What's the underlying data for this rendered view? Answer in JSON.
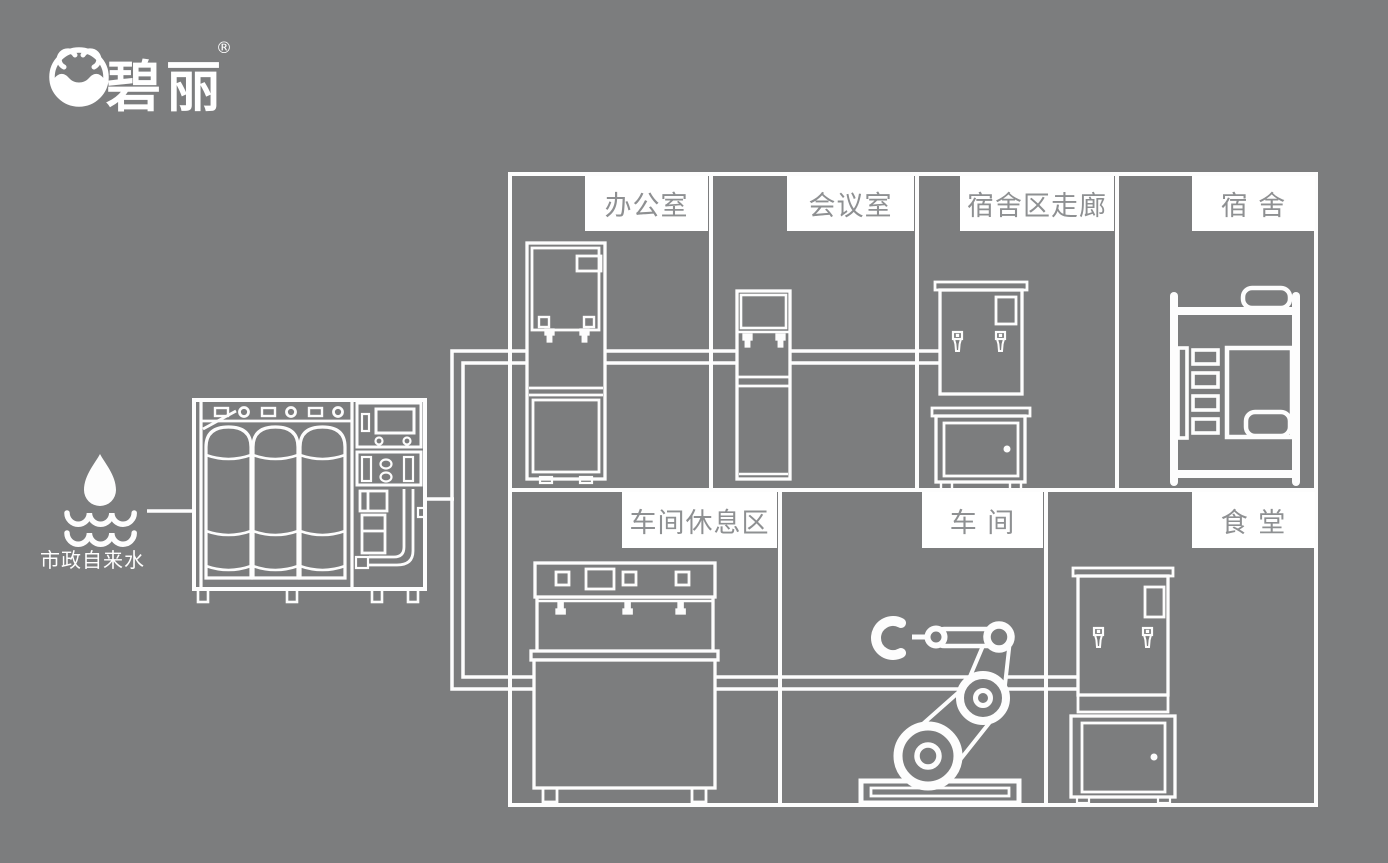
{
  "colors": {
    "background": "#7c7d7e",
    "line": "#fdfdfd",
    "label_background": "#ffffff",
    "label_text": "#8e9092"
  },
  "brand": {
    "name": "碧丽",
    "registered_mark": "®",
    "icon": "water-bowl-logo-icon"
  },
  "water_source": {
    "label": "市政自来水",
    "icon": "water-drop-waves-icon"
  },
  "treatment_system": {
    "icon": "ro-water-treatment-machine"
  },
  "rooms": [
    {
      "id": "office",
      "label": "办公室",
      "equipment_icon": "floor-standing-water-dispenser"
    },
    {
      "id": "meeting-room",
      "label": "会议室",
      "equipment_icon": "slim-water-dispenser"
    },
    {
      "id": "dorm-corridor",
      "label": "宿舍区走廊",
      "equipment_icon": "hot-water-boiler-with-cabinet"
    },
    {
      "id": "dormitory",
      "label": "宿 舍",
      "equipment_icon": "bunk-bed"
    },
    {
      "id": "workshop-rest-area",
      "label": "车间休息区",
      "equipment_icon": "multi-tap-water-dispenser"
    },
    {
      "id": "workshop",
      "label": "车 间",
      "equipment_icon": "robot-arm"
    },
    {
      "id": "canteen",
      "label": "食 堂",
      "equipment_icon": "hot-water-boiler-with-cabinet"
    }
  ]
}
